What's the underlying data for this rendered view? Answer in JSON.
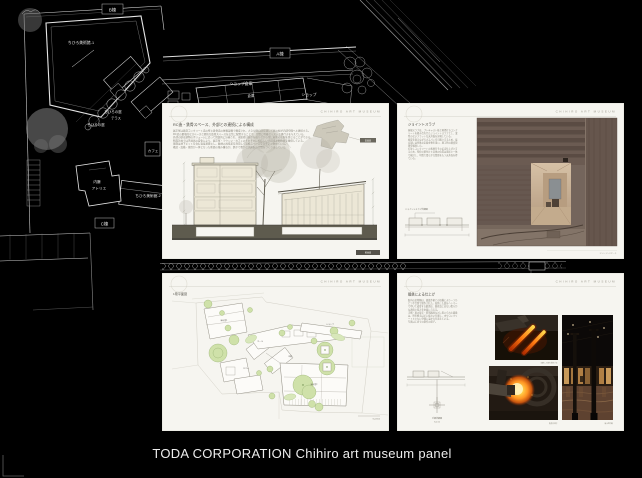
{
  "caption_bar": {
    "text": "TODA CORPORATION Chihiro art museum panel"
  },
  "cad": {
    "labels": {
      "wing_b": "B棟",
      "museum_1": "ちひろ美術館-1",
      "wing_a": "A棟",
      "shop_warehouse": "ショップ倉庫",
      "warehouse": "倉庫",
      "shop": "ショップ",
      "cafe": "カフェ",
      "chihiro_garden": "ちひろの庭",
      "terrace": "テラス",
      "chihiro_garden_2": "ちひろの庭",
      "naito_line1": "内藤",
      "naito_line2": "アトリエ",
      "museum_2": "ちひろ美術館-2",
      "wing_c": "C棟"
    }
  },
  "panels": {
    "header": "CHIHIRO ART MUSEUM",
    "section": {
      "title": "RC造・鉄骨スペース、外部との連続による構成",
      "para": [
        "展示室は鉄筋コンクリート造の壁と鉄骨造の屋根架構で構成され、大きな開口部を通して庭の緑が内部空間へと連続する。",
        "RC造の量塊的なスペースと軽快な鉄骨スペースを交互に配置することで、空間に明確なリズムと奥行きを与えている。",
        "外部の庭は建物のボリュームに沿って回遊的に計画され、来館者は展示を巡りながら常に樹木の気配を感じることができる。",
        "断面計画では天井高の変化により、展示室・ラウンジ・カフェのそれぞれに相応しい光環境と開放感を確保している。",
        "基礎は地下ピットを含む直接基礎とし、敷地の高低差を利用して設備スペースを効率よく納めている。",
        "構造・設備・意匠が一体となった断面の積み重ねが、静かで豊かな美術館の空間をつくり出している。"
      ],
      "sketch_label": "配置図",
      "caption": "断面図"
    },
    "slab": {
      "title": "ジョイントスラブ",
      "para": [
        "屋根スラブは、プレキャスト板と現場打ちコンク",
        "リートを組み合わせたジョイントスラブとし、梁",
        "型のないフラットな天井面を実現している。",
        "板厚を抑えながら大スパンを可能とするため、接",
        "合部には特殊な定着金物を用い、施工時の精度管",
        "理を徹底した。",
        "打放しコンクリートの素地をそのまま仕上げとす",
        "るため、型枠の割付けと目地の位置は意匠と一体",
        "で検討し、均質で柔らかな質感をもつ天井面を得",
        "ている。"
      ],
      "detail_label": "ジョイントスラブ詳細図",
      "caption": "エントランスポーチ"
    },
    "plan": {
      "title": "1階平面図",
      "labels": {
        "l1": "展示室1",
        "l2": "ホール",
        "l3": "中庭",
        "l4": "展示室2",
        "l5": "ショップ",
        "l6": "カフェ"
      },
      "scale": "S=1/600"
    },
    "forge": {
      "title": "鍛鉄による仕上げ",
      "para": [
        "館内の金物類は、鍛鉄作家との協働により一つひ",
        "とつ手仕事で制作された。加熱した鉄をハンマー",
        "で叩いて成形する鍛造は、量産品にはない柔らか",
        "な表情と厚みを金属に与える。",
        "手摺・扉の取手・照明器具などに用いられた鍛鉄",
        "は、時を経るほどに味わいを増し、木やコンクリ",
        "ートとともに空間に温かみを添えている。",
        "写真は工房での制作の様子。"
      ],
      "detail_label_1": "手摺詳細図",
      "detail_label_2": "S=1/10",
      "caption_a": "加熱した鉄を成形する",
      "caption_b": "鍛造の様子",
      "caption_c": "展示室内観"
    }
  }
}
